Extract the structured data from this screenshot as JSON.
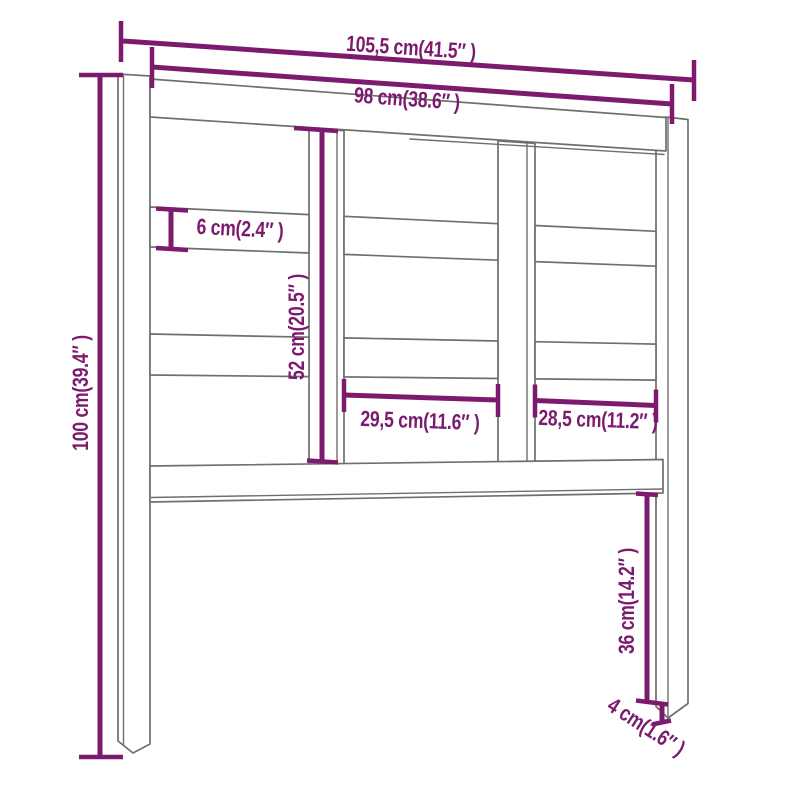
{
  "diagram": {
    "title": "Headboard dimension drawing",
    "product": "bed headboard with posts, rails and slats",
    "style": "technical line drawing in slight perspective",
    "background_color": "#ffffff",
    "outline_color": "#6f6f6f",
    "accent_color": "#7c1b6d",
    "dimensions": {
      "overall_width": {
        "cm": 105.5,
        "inch": 41.5,
        "label": "105,5 cm(41.5″ )"
      },
      "inner_width": {
        "cm": 98,
        "inch": 38.6,
        "label": "98 cm(38.6″ )"
      },
      "height": {
        "cm": 100,
        "inch": 39.4,
        "label": "100 cm(39.4″ )"
      },
      "slat_height": {
        "cm": 6,
        "inch": 2.4,
        "label": "6 cm(2.4″ )"
      },
      "panel_height": {
        "cm": 52,
        "inch": 20.5,
        "label": "52 cm(20.5″ )"
      },
      "middle_section_width": {
        "cm": 29.5,
        "inch": 11.6,
        "label": "29,5 cm(11.6″ )"
      },
      "right_section_width": {
        "cm": 28.5,
        "inch": 11.2,
        "label": "28,5 cm(11.2″ )"
      },
      "leg_height": {
        "cm": 36,
        "inch": 14.2,
        "label": "36 cm(14.2″ )"
      },
      "post_thickness": {
        "cm": 4,
        "inch": 1.6,
        "label": "4 cm(1.6″ )"
      }
    }
  }
}
